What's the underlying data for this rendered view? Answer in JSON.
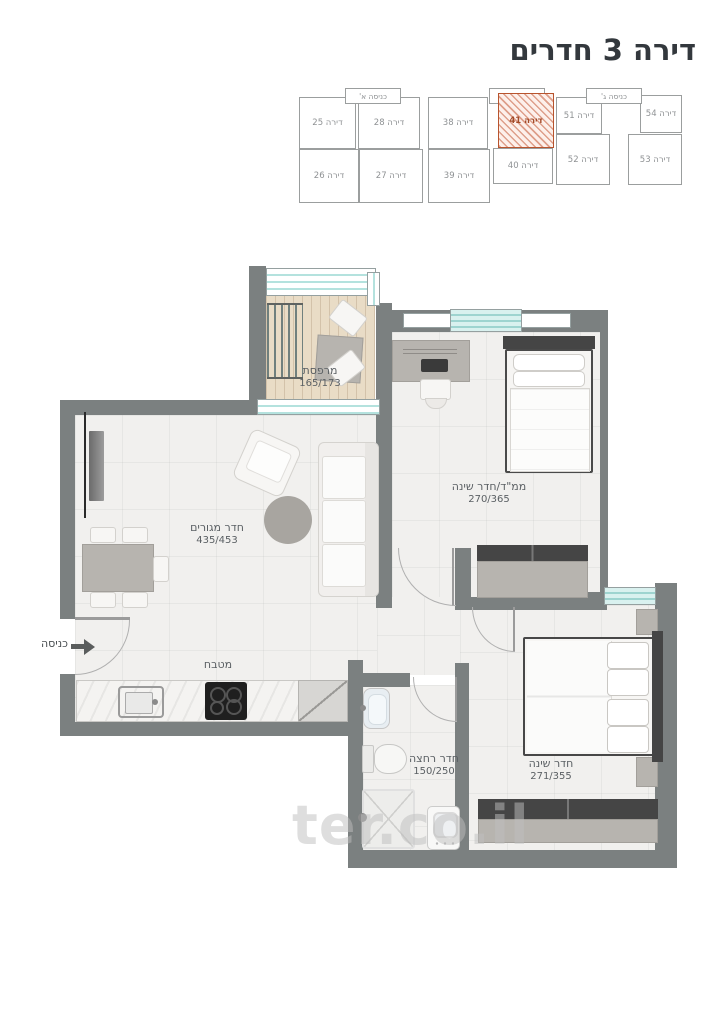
{
  "title": "דירה 3 חדרים",
  "watermark": "ter.co.il",
  "key_plan": {
    "entrances": [
      {
        "label": "כניסה א'"
      },
      {
        "label": "כניסה ב'"
      },
      {
        "label": "כניסה ג'"
      }
    ],
    "units": [
      {
        "label": "דירה 25",
        "highlighted": false
      },
      {
        "label": "דירה 28",
        "highlighted": false
      },
      {
        "label": "דירה 38",
        "highlighted": false
      },
      {
        "label": "דירה 41",
        "highlighted": true
      },
      {
        "label": "דירה 51",
        "highlighted": false
      },
      {
        "label": "דירה 54",
        "highlighted": false
      },
      {
        "label": "דירה 26",
        "highlighted": false
      },
      {
        "label": "דירה 27",
        "highlighted": false
      },
      {
        "label": "דירה 39",
        "highlighted": false
      },
      {
        "label": "דירה 40",
        "highlighted": false
      },
      {
        "label": "דירה 52",
        "highlighted": false
      },
      {
        "label": "דירה 53",
        "highlighted": false
      }
    ]
  },
  "floor_plan": {
    "entrance_label": "כניסה",
    "rooms": [
      {
        "name": "מרפסת",
        "dims": "165/173"
      },
      {
        "name": "ממ\"ד/חדר שינה",
        "dims": "270/365"
      },
      {
        "name": "חדר מגורים",
        "dims": "435/453"
      },
      {
        "name": "מטבח",
        "dims": ""
      },
      {
        "name": "חדר רחצה",
        "dims": "150/250"
      },
      {
        "name": "חדר שינה",
        "dims": "271/355"
      }
    ]
  },
  "colors": {
    "wall": "#7b8080",
    "glass": "#b4e2de",
    "wood_floor": "#e9dcc6",
    "highlight": "#b8542e"
  }
}
